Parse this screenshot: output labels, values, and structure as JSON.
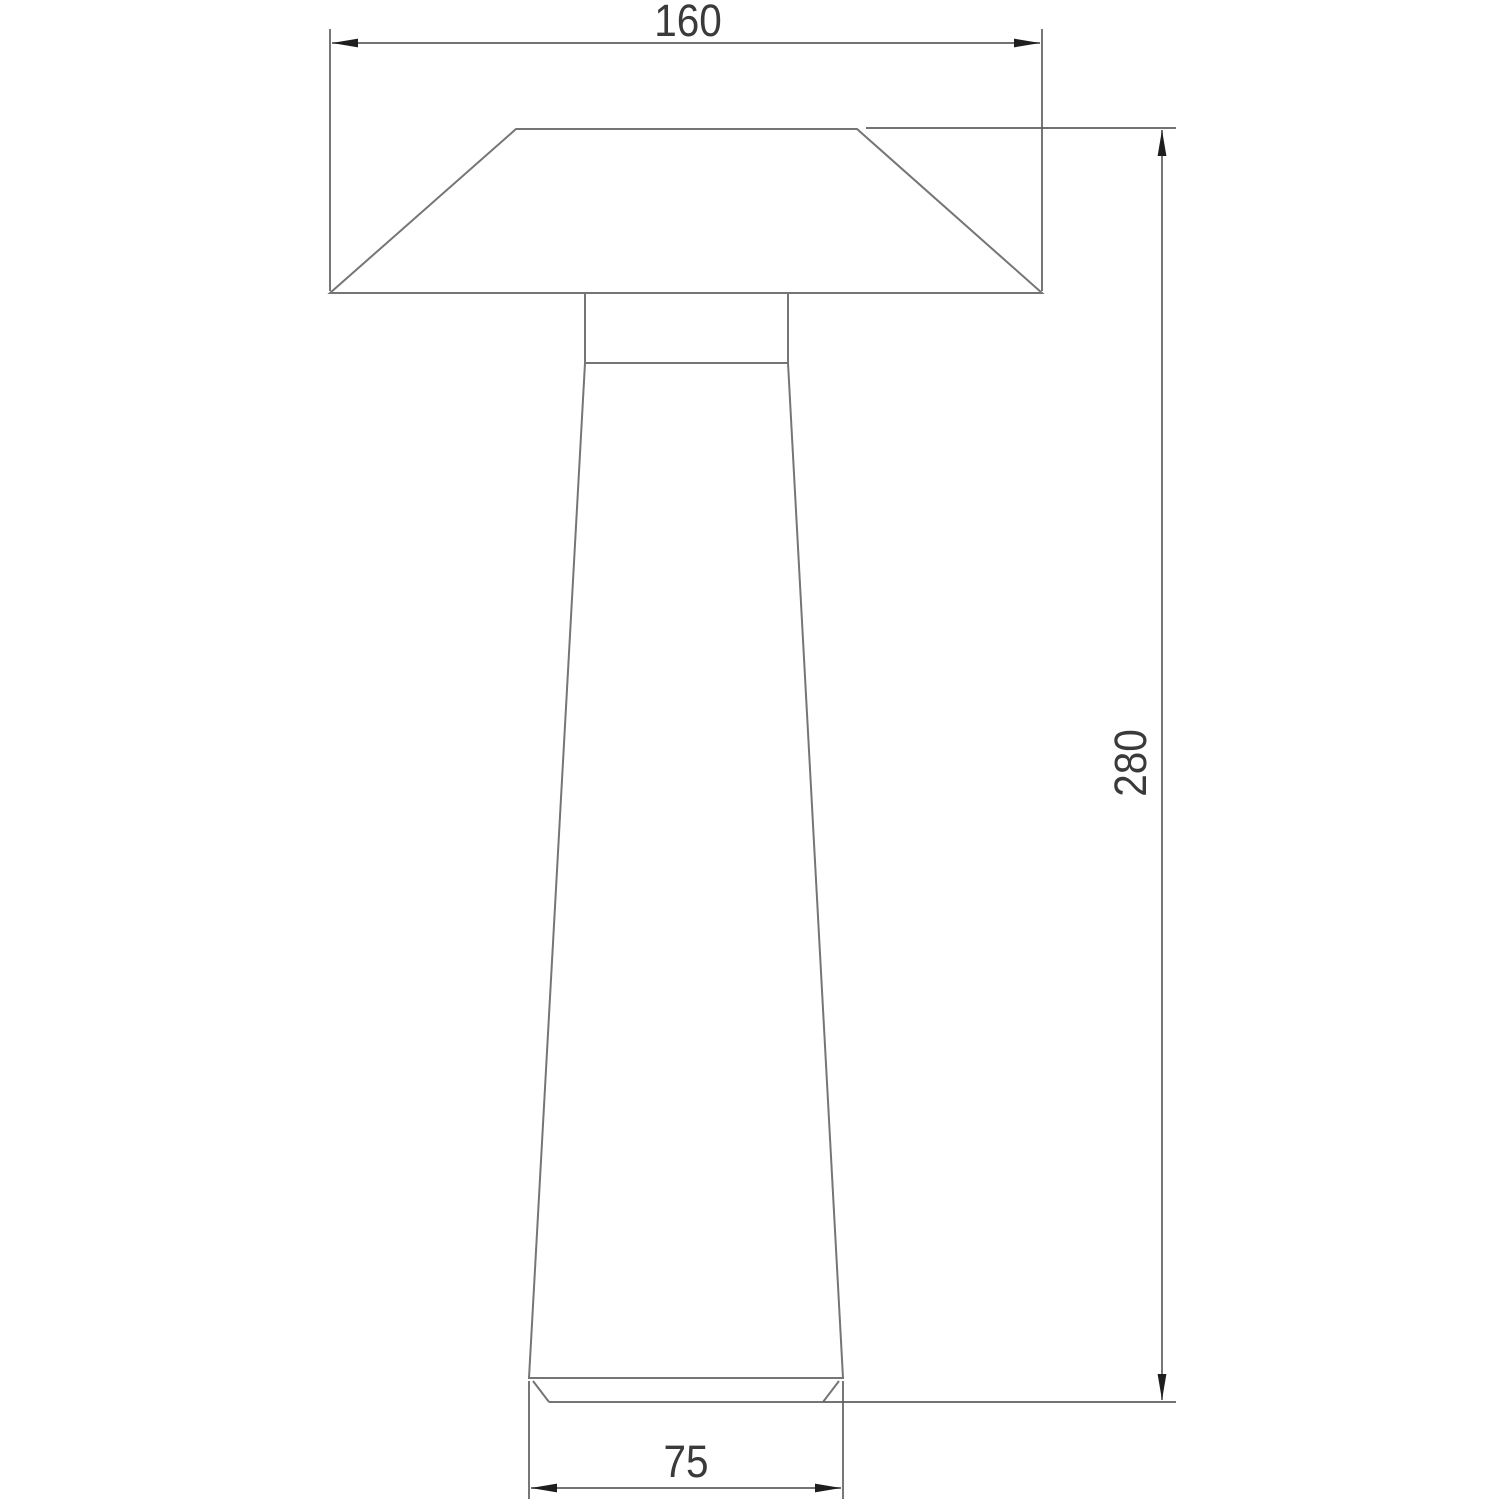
{
  "drawing": {
    "kind": "technical-dimension-drawing",
    "subject": "table-lamp-front-elevation",
    "parts": [
      "shade",
      "neck",
      "body",
      "base"
    ],
    "colors": {
      "background": "#ffffff",
      "outline": "#757575",
      "dimension": "#5f5f5f",
      "arrow": "#1e1e1e",
      "text": "#3a3a3a"
    },
    "dimensions": [
      {
        "id": "shade-width",
        "label": "160",
        "value": 160,
        "orientation": "horizontal",
        "position": "top"
      },
      {
        "id": "overall-height",
        "label": "280",
        "value": 280,
        "orientation": "vertical",
        "position": "right"
      },
      {
        "id": "base-width",
        "label": "75",
        "value": 75,
        "orientation": "horizontal",
        "position": "bottom"
      }
    ]
  }
}
